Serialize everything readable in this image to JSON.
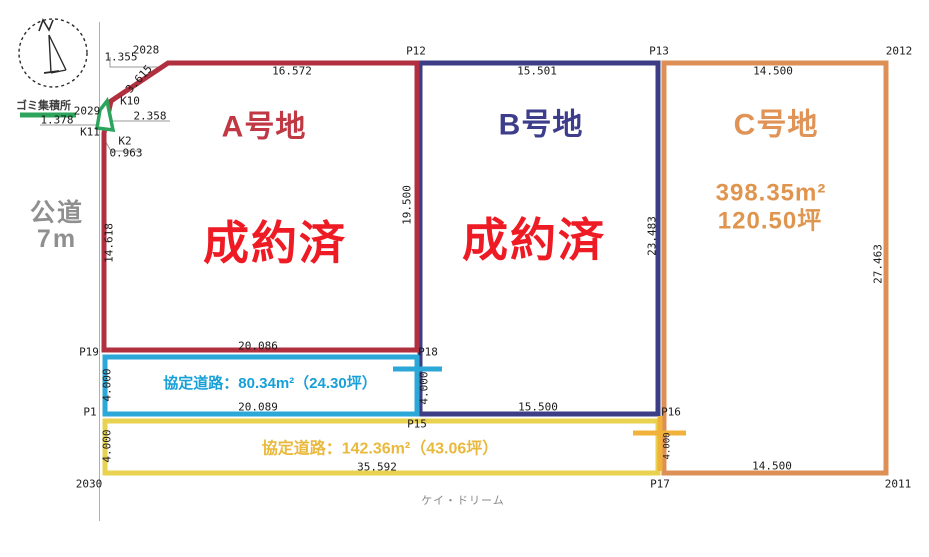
{
  "meta": {
    "credit": "ケイ・ドリーム"
  },
  "left_road": {
    "line1": "公道",
    "line2": "7m"
  },
  "garbage_station": {
    "label": "ゴミ集積所"
  },
  "plots": {
    "a": {
      "name": "A号地",
      "status": "成約済"
    },
    "b": {
      "name": "B号地",
      "status": "成約済"
    },
    "c": {
      "name": "C号地",
      "area_m2": "398.35m²",
      "area_tsubo": "120.50坪"
    }
  },
  "agreement_roads": {
    "upper": {
      "label": "協定道路：80.34m²（24.30坪）"
    },
    "lower": {
      "label": "協定道路：142.36m²（43.06坪）"
    }
  },
  "points": {
    "p12": "P12",
    "p13": "P13",
    "p15": "P15",
    "p16": "P16",
    "p17": "P17",
    "p18": "P18",
    "p19": "P19",
    "p1": "P1",
    "n2011": "2011",
    "n2012": "2012",
    "n2028": "2028",
    "n2029": "2029",
    "n2030": "2030",
    "k10": "K10",
    "k11": "K11",
    "k2": "K2"
  },
  "dimensions": {
    "a_top": "16.572",
    "b_top": "15.501",
    "c_top": "14.500",
    "a_left": "14.618",
    "ab_boundary": "19.500",
    "bc_boundary": "23.483",
    "c_right": "27.463",
    "a_bottom": "20.086",
    "cyan_bottom": "20.089",
    "b_bottom": "15.500",
    "yellow_bottom": "35.592",
    "c_bottom": "14.500",
    "cyan_left": "4.000",
    "cyan_right": "4.000",
    "yellow_left": "4.000",
    "p16_side": "4.000",
    "s1355": "1.355",
    "s3615": "3.615",
    "s2358": "2.358",
    "s0963": "0.963",
    "s1378": "1.378"
  },
  "colors": {
    "plot_a_border": "#b13040",
    "plot_b_border": "#3d3d85",
    "plot_c_border": "#dd9055",
    "road_upper": "#2ba7d8",
    "road_lower": "#e8d24f",
    "tick_gold": "#f0b23a",
    "status_red": "#ee1b24",
    "green": "#2ca45c"
  }
}
